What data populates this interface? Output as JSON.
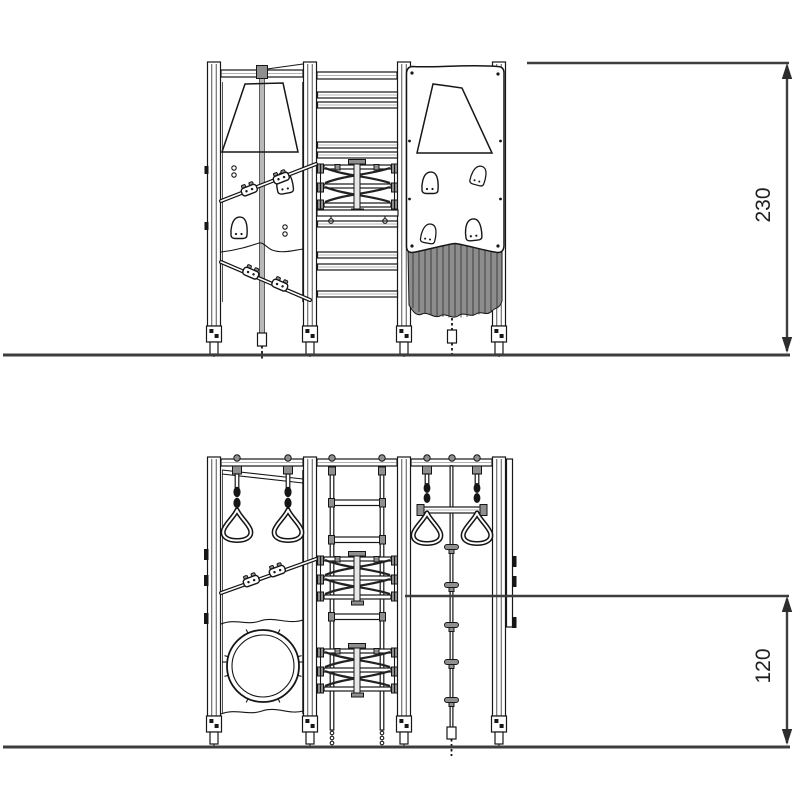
{
  "views": {
    "front": {
      "name": "upper-elevation",
      "dimension_label": "230"
    },
    "side": {
      "name": "lower-elevation",
      "dimension_label": "120"
    }
  },
  "colors": {
    "line": "#161616",
    "dimension_line": "#3d3d3d",
    "label_text": "#1f1f1f",
    "background": "#ffffff"
  }
}
